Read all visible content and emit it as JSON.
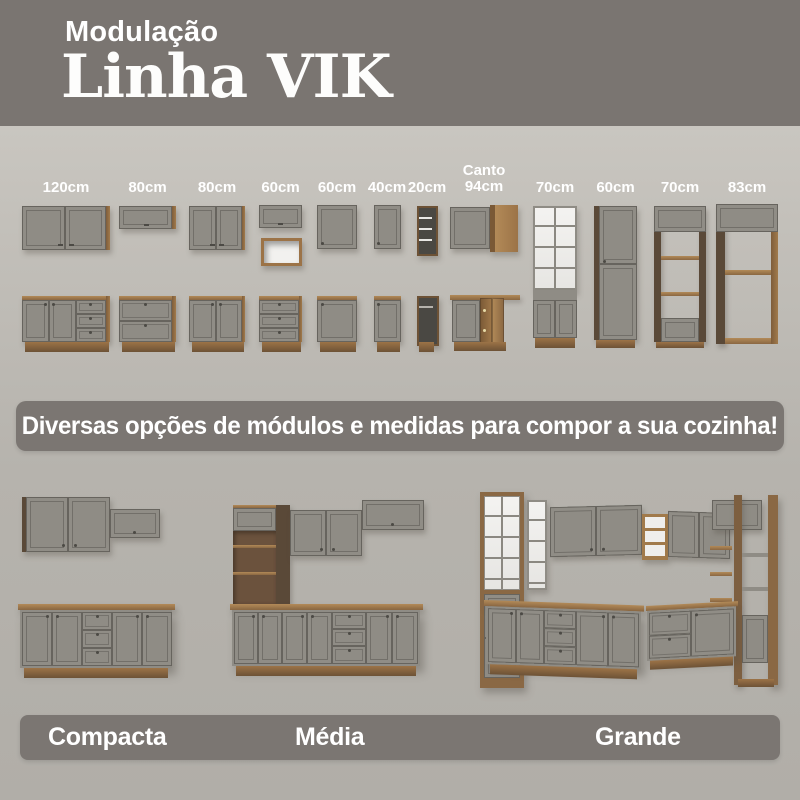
{
  "header": {
    "subtitle": "Modulação",
    "title": "Linha VIK"
  },
  "module_labels": [
    "120cm",
    "80cm",
    "80cm",
    "60cm",
    "60cm",
    "40cm",
    "20cm",
    "Canto 94cm",
    "70cm",
    "60cm",
    "70cm",
    "83cm"
  ],
  "banner": {
    "text": "Diversas opções de módulos e medidas para compor a sua cozinha!"
  },
  "kitchens": [
    {
      "label": "Compacta"
    },
    {
      "label": "Média"
    },
    {
      "label": "Grande"
    }
  ],
  "colors": {
    "header_bg": "#7a7571",
    "banner_bg": "#7b7672",
    "page_bg": "#bdbab4",
    "cabinet_gray": "#8f8c85",
    "wood": "#9c7347",
    "wood_dark": "#5a4938",
    "glass_white": "#f2f1ef",
    "text_white": "#ffffff"
  }
}
